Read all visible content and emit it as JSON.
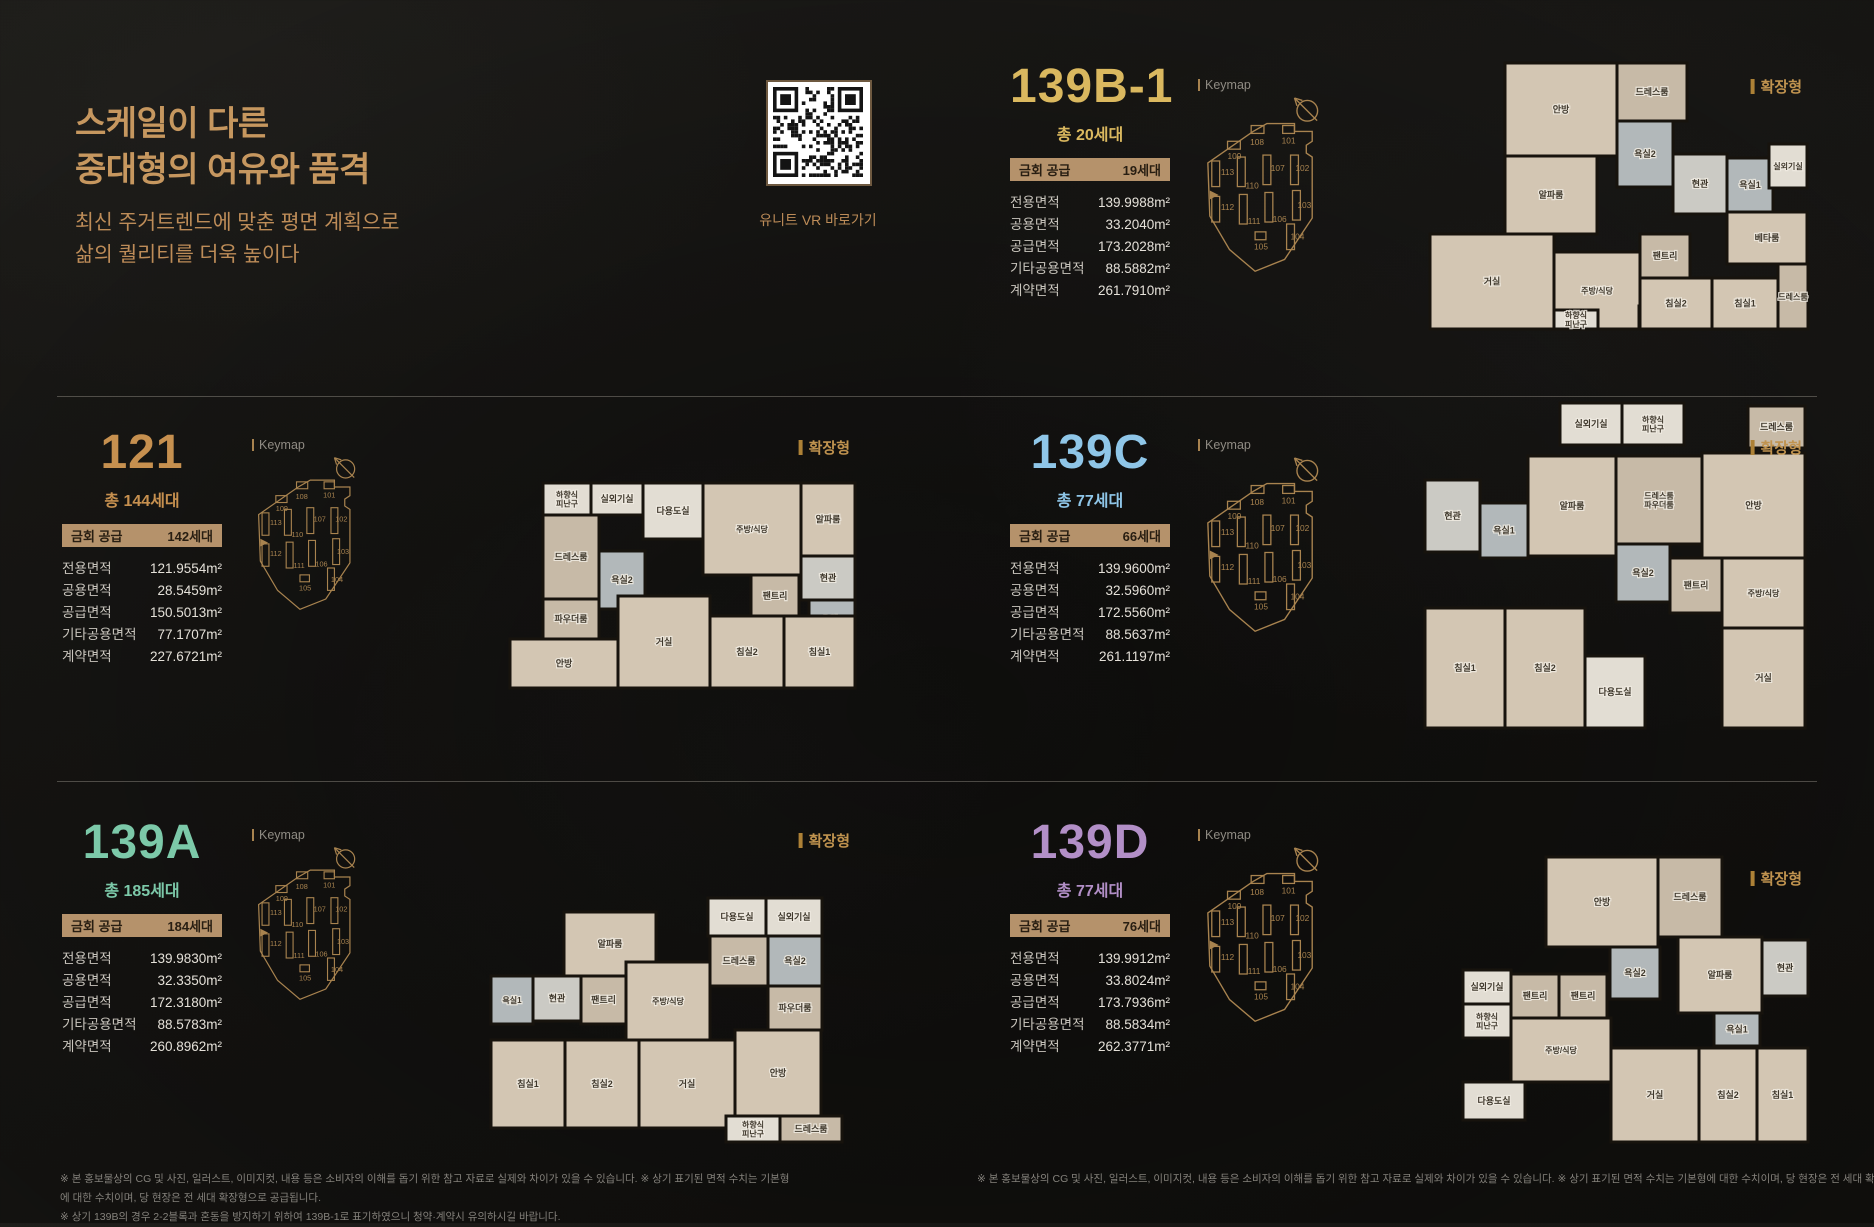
{
  "page": {
    "heading": "스케일이 다른\n중대형의 여유와 품격",
    "subheading": "최신 주거트렌드에 맞춘 평면 계획으로\n삶의 퀄리티를 더욱 높이다",
    "qr_caption": "유니트 VR 바로가기",
    "keymap_label": "Keymap",
    "expand_label": "확장형",
    "supply_label": "금회 공급"
  },
  "colors": {
    "accent_gold": "#c6975f",
    "accent_sub": "#bd8c58",
    "badge_bg": "#b5926b",
    "badge_text": "#281e12",
    "table_label": "#c9c5bd",
    "table_value": "#e5e1d9",
    "keymap": "#a8834f",
    "expand": "#c0934f",
    "separator": "rgba(190,184,172,0.35)",
    "plan_wall": "#17130d",
    "plan_floor": "#d3c6b3",
    "plan_floor_alt": "#c7baa7",
    "plan_bath": "#b2b8ba",
    "plan_tile": "#cbcac4",
    "plan_light": "#e2ddd3",
    "plan_label": "#3f382c"
  },
  "units": [
    {
      "id": "139B-1",
      "title": "139B-1",
      "accent": "#dab85f",
      "total": "총 20세대",
      "supply": "19세대",
      "areas": [
        {
          "label": "전용면적",
          "value": "139.9988m²"
        },
        {
          "label": "공용면적",
          "value": "33.2040m²"
        },
        {
          "label": "공급면적",
          "value": "173.2028m²"
        },
        {
          "label": "기타공용면적",
          "value": "88.5882m²"
        },
        {
          "label": "계약면적",
          "value": "261.7910m²"
        }
      ],
      "floorplan": {
        "w": 385,
        "h": 278,
        "rooms": [
          [
            "안방",
            80,
            5,
            112,
            93,
            "f"
          ],
          [
            "드레스룸",
            192,
            5,
            70,
            58,
            "f2"
          ],
          [
            "욕실2",
            192,
            63,
            56,
            66,
            "b"
          ],
          [
            "알파룸",
            80,
            98,
            92,
            78,
            "f"
          ],
          [
            "현관",
            248,
            96,
            54,
            60,
            "t"
          ],
          [
            "욕실1",
            302,
            100,
            46,
            54,
            "b"
          ],
          [
            "실외기실",
            344,
            86,
            38,
            44,
            "l"
          ],
          [
            "베타룸",
            302,
            154,
            80,
            52,
            "f"
          ],
          [
            "거실",
            5,
            176,
            124,
            95,
            "f"
          ],
          [
            "주방/식당",
            129,
            194,
            86,
            77,
            "f"
          ],
          [
            "하향식 피난구",
            129,
            252,
            44,
            19,
            "l"
          ],
          [
            "다용도실",
            214,
            248,
            52,
            23,
            "l"
          ],
          [
            "팬트리",
            215,
            176,
            50,
            44,
            "f2"
          ],
          [
            "침실2",
            215,
            220,
            72,
            51,
            "f"
          ],
          [
            "침실1",
            287,
            220,
            66,
            51,
            "f"
          ],
          [
            "드레스룸",
            353,
            206,
            30,
            65,
            "f2"
          ]
        ]
      }
    },
    {
      "id": "121",
      "title": "121",
      "accent": "#c6904f",
      "total": "총 144세대",
      "supply": "142세대",
      "areas": [
        {
          "label": "전용면적",
          "value": "121.9554m²"
        },
        {
          "label": "공용면적",
          "value": "28.5459m²"
        },
        {
          "label": "공급면적",
          "value": "150.5013m²"
        },
        {
          "label": "기타공용면적",
          "value": "77.1707m²"
        },
        {
          "label": "계약면적",
          "value": "227.6721m²"
        }
      ],
      "floorplan": {
        "w": 355,
        "h": 215,
        "rooms": [
          [
            "하향식 피난구",
            38,
            5,
            48,
            32,
            "l"
          ],
          [
            "실외기실",
            86,
            5,
            52,
            32,
            "l"
          ],
          [
            "다용도실",
            138,
            5,
            60,
            56,
            "l"
          ],
          [
            "주방/식당",
            198,
            5,
            98,
            92,
            "f"
          ],
          [
            "알파룸",
            296,
            5,
            54,
            73,
            "f"
          ],
          [
            "드레스룸",
            38,
            37,
            56,
            84,
            "f2"
          ],
          [
            "파우더룸",
            38,
            121,
            56,
            40,
            "f2"
          ],
          [
            "욕실2",
            94,
            73,
            46,
            58,
            "b"
          ],
          [
            "팬트리",
            246,
            97,
            48,
            42,
            "f2"
          ],
          [
            "현관",
            296,
            78,
            54,
            44,
            "t"
          ],
          [
            "욕실1",
            304,
            122,
            46,
            40,
            "b"
          ],
          [
            "안방",
            5,
            161,
            108,
            49,
            "f"
          ],
          [
            "거실",
            113,
            118,
            92,
            92,
            "f"
          ],
          [
            "침실2",
            205,
            138,
            74,
            72,
            "f"
          ],
          [
            "침실1",
            279,
            138,
            71,
            72,
            "f"
          ]
        ]
      }
    },
    {
      "id": "139C",
      "title": "139C",
      "accent": "#8fc6e8",
      "total": "총 77세대",
      "supply": "66세대",
      "areas": [
        {
          "label": "전용면적",
          "value": "139.9600m²"
        },
        {
          "label": "공용면적",
          "value": "32.5960m²"
        },
        {
          "label": "공급면적",
          "value": "172.5560m²"
        },
        {
          "label": "기타공용면적",
          "value": "88.5637m²"
        },
        {
          "label": "계약면적",
          "value": "261.1197m²"
        }
      ],
      "floorplan": {
        "w": 390,
        "h": 340,
        "rooms": [
          [
            "실외기실",
            140,
            5,
            62,
            42,
            "l"
          ],
          [
            "하향식 피난구",
            202,
            5,
            62,
            42,
            "l"
          ],
          [
            "드레스룸",
            328,
            8,
            57,
            42,
            "f2"
          ],
          [
            "현관",
            5,
            82,
            55,
            72,
            "t"
          ],
          [
            "욕실1",
            60,
            105,
            48,
            55,
            "b"
          ],
          [
            "알파룸",
            108,
            58,
            88,
            100,
            "f"
          ],
          [
            "드레스룸 파우더룸",
            196,
            58,
            86,
            88,
            "f2"
          ],
          [
            "안방",
            282,
            55,
            103,
            105,
            "f"
          ],
          [
            "욕실2",
            196,
            146,
            54,
            58,
            "b"
          ],
          [
            "팬트리",
            250,
            160,
            52,
            55,
            "f2"
          ],
          [
            "주방/식당",
            302,
            160,
            83,
            70,
            "f"
          ],
          [
            "침실1",
            5,
            210,
            80,
            120,
            "f"
          ],
          [
            "침실2",
            85,
            210,
            80,
            120,
            "f"
          ],
          [
            "다용도실",
            165,
            258,
            60,
            72,
            "l"
          ],
          [
            "거실",
            302,
            230,
            83,
            100,
            "f"
          ]
        ]
      }
    },
    {
      "id": "139A",
      "title": "139A",
      "accent": "#7cc9a9",
      "total": "총 185세대",
      "supply": "184세대",
      "areas": [
        {
          "label": "전용면적",
          "value": "139.9830m²"
        },
        {
          "label": "공용면적",
          "value": "32.3350m²"
        },
        {
          "label": "공급면적",
          "value": "172.3180m²"
        },
        {
          "label": "기타공용면적",
          "value": "88.5783m²"
        },
        {
          "label": "계약면적",
          "value": "260.8962m²"
        }
      ],
      "floorplan": {
        "w": 370,
        "h": 268,
        "rooms": [
          [
            "알파룸",
            78,
            28,
            92,
            64,
            "f"
          ],
          [
            "다용도실",
            222,
            14,
            58,
            38,
            "l"
          ],
          [
            "실외기실",
            280,
            14,
            56,
            38,
            "l"
          ],
          [
            "욕실1",
            5,
            92,
            42,
            48,
            "b"
          ],
          [
            "현관",
            47,
            92,
            48,
            45,
            "t"
          ],
          [
            "팬트리",
            95,
            92,
            45,
            48,
            "f2"
          ],
          [
            "주방/식당",
            140,
            78,
            84,
            78,
            "f"
          ],
          [
            "드레스룸",
            224,
            52,
            58,
            50,
            "f2"
          ],
          [
            "욕실2",
            282,
            52,
            54,
            50,
            "b"
          ],
          [
            "파우더룸",
            282,
            102,
            54,
            44,
            "f2"
          ],
          [
            "침실1",
            5,
            156,
            74,
            88,
            "f"
          ],
          [
            "침실2",
            79,
            156,
            74,
            88,
            "f"
          ],
          [
            "거실",
            153,
            156,
            96,
            88,
            "f"
          ],
          [
            "안방",
            249,
            146,
            86,
            86,
            "f"
          ],
          [
            "하향식 피난구",
            240,
            232,
            54,
            26,
            "l"
          ],
          [
            "드레스룸",
            294,
            232,
            62,
            26,
            "f2"
          ]
        ]
      }
    },
    {
      "id": "139D",
      "title": "139D",
      "accent": "#b28fc7",
      "total": "총 77세대",
      "supply": "76세대",
      "areas": [
        {
          "label": "전용면적",
          "value": "139.9912m²"
        },
        {
          "label": "공용면적",
          "value": "33.8024m²"
        },
        {
          "label": "공급면적",
          "value": "173.7936m²"
        },
        {
          "label": "기타공용면적",
          "value": "88.5834m²"
        },
        {
          "label": "계약면적",
          "value": "262.3771m²"
        }
      ],
      "floorplan": {
        "w": 355,
        "h": 300,
        "rooms": [
          [
            "안방",
            88,
            5,
            112,
            90,
            "f"
          ],
          [
            "드레스룸",
            200,
            5,
            64,
            80,
            "f2"
          ],
          [
            "알파룸",
            220,
            85,
            84,
            76,
            "f"
          ],
          [
            "욕실2",
            152,
            95,
            50,
            52,
            "b"
          ],
          [
            "현관",
            304,
            88,
            46,
            56,
            "t"
          ],
          [
            "욕실1",
            256,
            161,
            46,
            33,
            "b"
          ],
          [
            "실외기실",
            5,
            118,
            48,
            34,
            "l"
          ],
          [
            "하향식 피난구",
            5,
            152,
            48,
            34,
            "l"
          ],
          [
            "팬트리",
            53,
            122,
            48,
            44,
            "f2"
          ],
          [
            "팬트리",
            101,
            122,
            48,
            44,
            "f2"
          ],
          [
            "주방/식당",
            53,
            166,
            100,
            64,
            "f"
          ],
          [
            "다용도실",
            5,
            230,
            62,
            38,
            "l"
          ],
          [
            "거실",
            153,
            196,
            88,
            94,
            "f"
          ],
          [
            "침실2",
            241,
            196,
            58,
            94,
            "f"
          ],
          [
            "침실1",
            299,
            196,
            51,
            94,
            "f"
          ]
        ]
      }
    }
  ],
  "keymap": {
    "outline": "M10,68 L56,36 L70,28 L98,28 L98,36 L116,36 L116,46 L110,50 L110,58 L116,62 L116,124 L88,166 L58,178 L32,156 L12,122 Z",
    "buildings": [
      {
        "n": "108",
        "rx": 54,
        "ry": 30,
        "rw": 13,
        "rh": 8,
        "lx": 60,
        "ly": 50
      },
      {
        "n": "101",
        "rx": 86,
        "ry": 30,
        "rw": 12,
        "rh": 8,
        "lx": 92,
        "ly": 48
      },
      {
        "n": "109",
        "rx": 30,
        "ry": 46,
        "rw": 13,
        "rh": 8,
        "lx": 37,
        "ly": 64
      },
      {
        "n": "113",
        "rx": 14,
        "ry": 66,
        "rw": 8,
        "rh": 26,
        "lx": 30,
        "ly": 80
      },
      {
        "n": "110",
        "rx": 40,
        "ry": 62,
        "rw": 8,
        "rh": 30,
        "lx": 55,
        "ly": 94
      },
      {
        "n": "107",
        "rx": 66,
        "ry": 60,
        "rw": 8,
        "rh": 30,
        "lx": 81,
        "ly": 76
      },
      {
        "n": "102",
        "rx": 94,
        "ry": 60,
        "rw": 8,
        "rh": 30,
        "lx": 106,
        "ly": 76
      },
      {
        "n": "112",
        "rx": 14,
        "ry": 102,
        "rw": 8,
        "rh": 26,
        "lx": 30,
        "ly": 116
      },
      {
        "n": "111",
        "rx": 42,
        "ry": 100,
        "rw": 8,
        "rh": 30,
        "lx": 57,
        "ly": 130
      },
      {
        "n": "106",
        "rx": 68,
        "ry": 98,
        "rw": 8,
        "rh": 30,
        "lx": 83,
        "ly": 128
      },
      {
        "n": "103",
        "rx": 96,
        "ry": 96,
        "rw": 8,
        "rh": 30,
        "lx": 108,
        "ly": 114
      },
      {
        "n": "105",
        "rx": 58,
        "ry": 138,
        "rw": 11,
        "rh": 8,
        "lx": 64,
        "ly": 156
      },
      {
        "n": "104",
        "rx": 90,
        "ry": 130,
        "rw": 8,
        "rh": 26,
        "lx": 101,
        "ly": 146
      }
    ]
  },
  "disclaimers": {
    "left": [
      "※ 본 홍보물상의 CG 및 사진, 일러스트, 이미지컷, 내용 등은 소비자의 이해를 돕기 위한 참고 자료로 실제와 차이가 있을 수 있습니다. ※ 상기 표기된 면적 수치는 기본형에 대한 수치이며, 당 현장은 전 세대 확장형으로 공급됩니다.",
      "※ 상기 139B의 경우 2-2블록과 혼동을 방지하기 위하여 139B-1로 표기하였으니 청약·계약시 유의하시길 바랍니다."
    ],
    "right": [
      "※ 본 홍보물상의 CG 및 사진, 일러스트, 이미지컷, 내용 등은 소비자의 이해를 돕기 위한 참고 자료로 실제와 차이가 있을 수 있습니다. ※ 상기 표기된 면적 수치는 기본형에 대한 수치이며, 당 현장은 전 세대 확장형으로 공급됩니다."
    ]
  }
}
